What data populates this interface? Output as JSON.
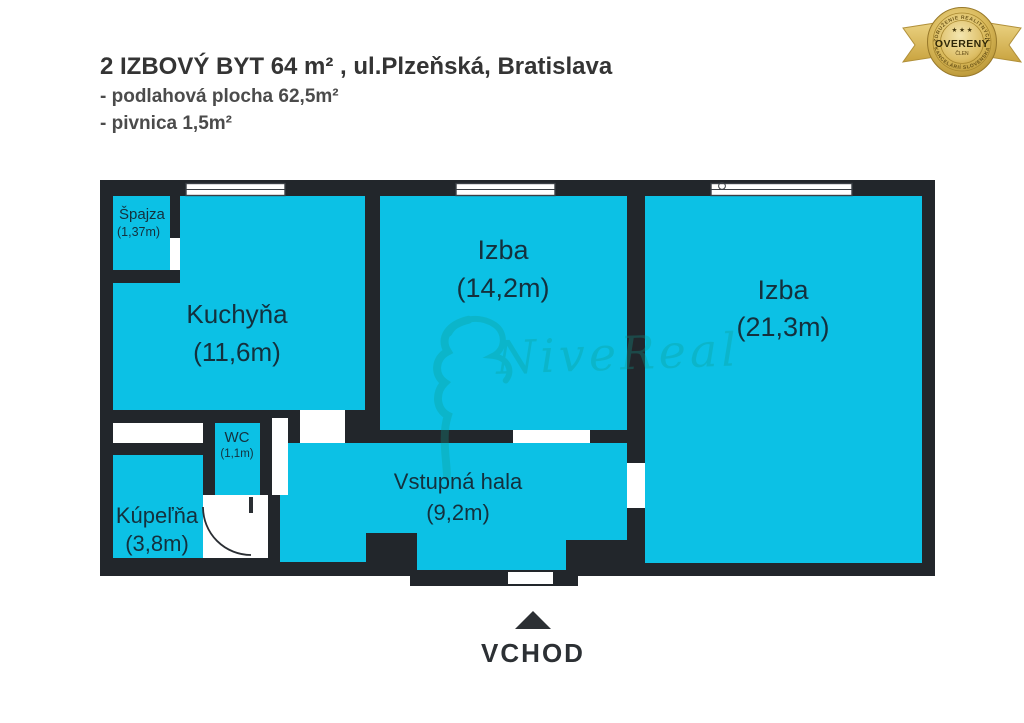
{
  "header": {
    "title": "2 IZBOVÝ BYT 64 m² , ul.Plzeňská, Bratislava",
    "subtitle1": "- podlahová plocha 62,5m²",
    "subtitle2": "- pivnica 1,5m²"
  },
  "badge": {
    "label": "OVERENÝ",
    "sublabel": "ČLEN",
    "ring_top": "ZDRUŽENIE REALITNÝCH",
    "ring_bottom": "KANCELÁRIÍ SLOVENSKA",
    "stars": "★ ★ ★",
    "gold": "#cda43e"
  },
  "watermark": {
    "text": "NiveReal"
  },
  "floorplan": {
    "wall_color": "#22262b",
    "room_fill": "#0cc1e5",
    "label_color": "#14303d",
    "entrance_label": "VCHOD",
    "rooms": [
      {
        "id": "spajza",
        "name": "Špajza",
        "area": "(1,37m)"
      },
      {
        "id": "kuchyna",
        "name": "Kuchyňa",
        "area": "(11,6m)"
      },
      {
        "id": "izba1",
        "name": "Izba",
        "area": "(14,2m)"
      },
      {
        "id": "izba2",
        "name": "Izba",
        "area": "(21,3m)"
      },
      {
        "id": "wc",
        "name": "WC",
        "area": "(1,1m)"
      },
      {
        "id": "kupelna",
        "name": "Kúpeľňa",
        "area": "(3,8m)"
      },
      {
        "id": "hala",
        "name": "Vstupná hala",
        "area": "(9,2m)"
      }
    ]
  }
}
